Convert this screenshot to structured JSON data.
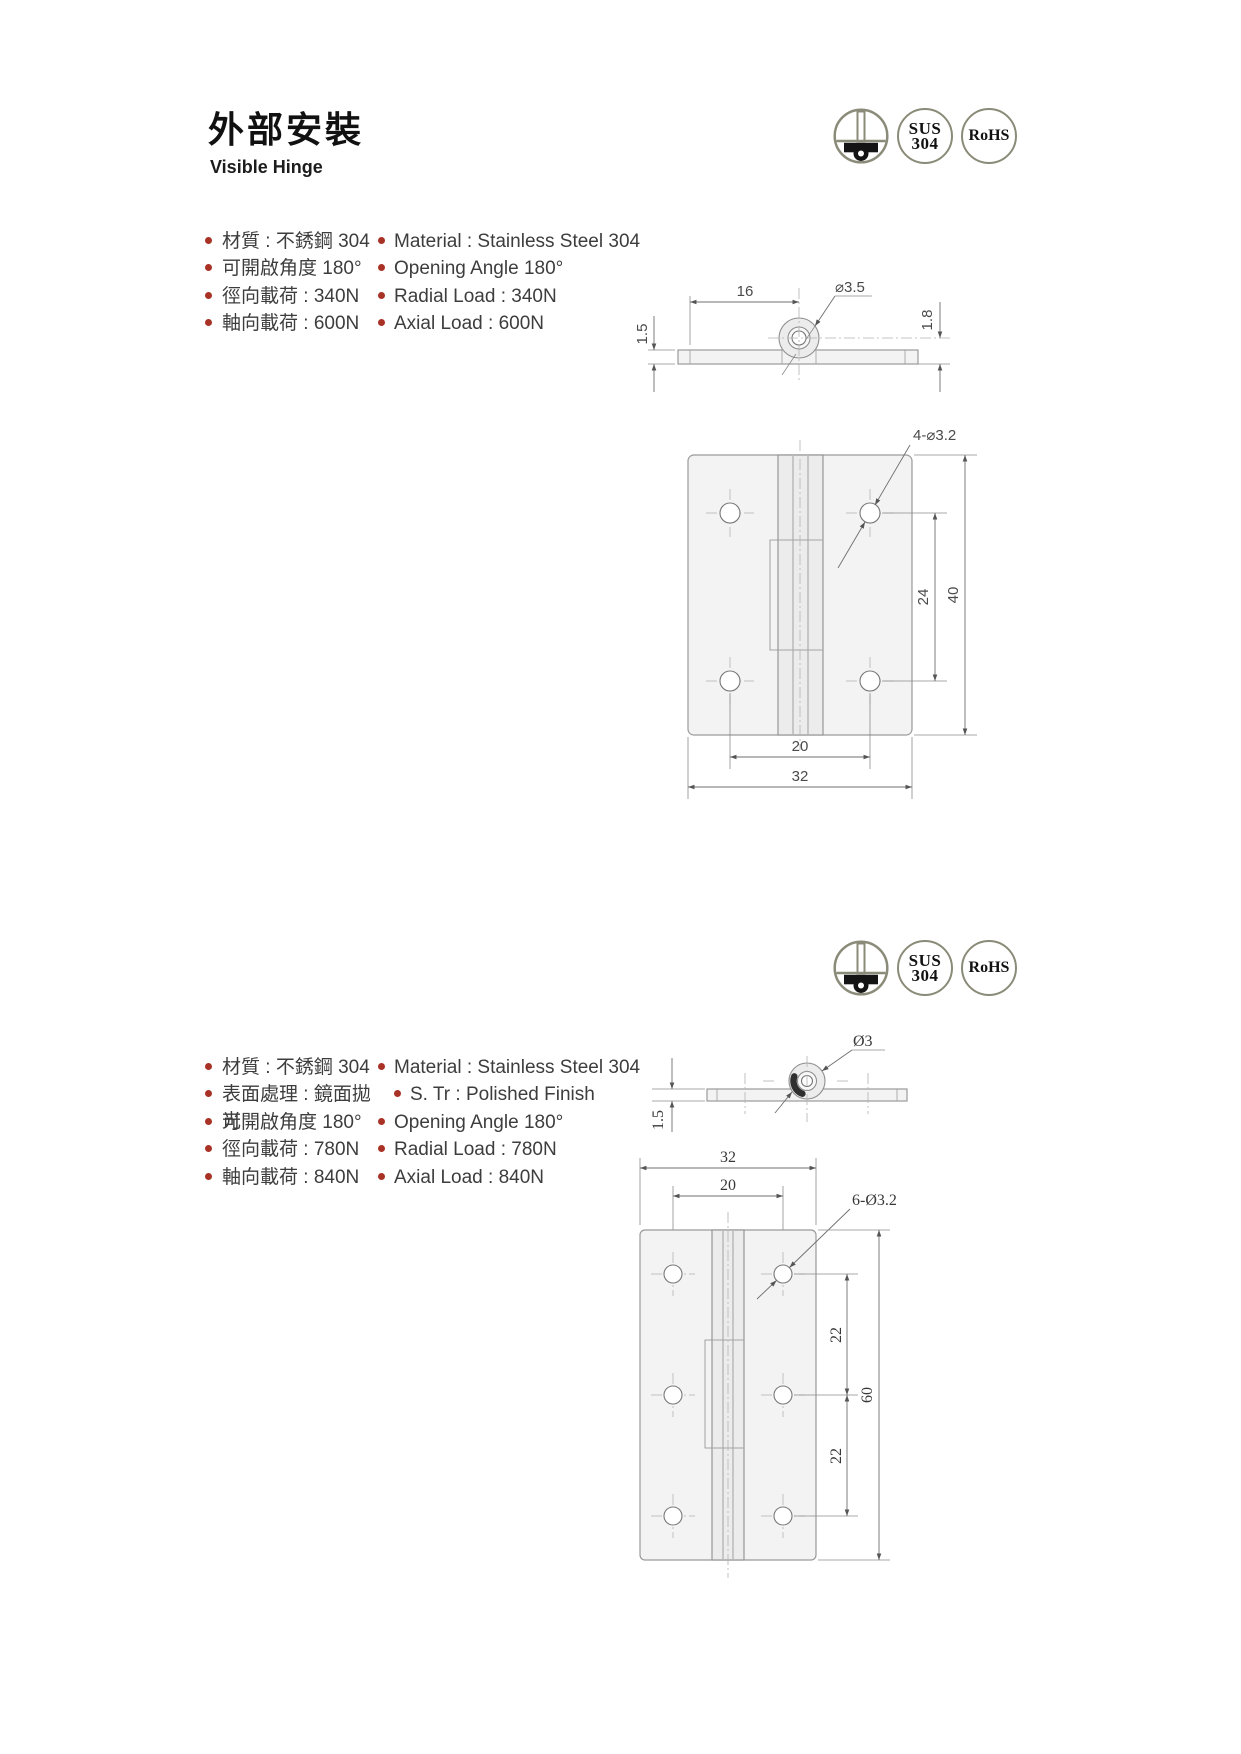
{
  "header": {
    "title_zh": "外部安裝",
    "title_en": "Visible Hinge"
  },
  "badges": {
    "sus_top": "SUS",
    "sus_bottom": "304",
    "rohs": "RoHS"
  },
  "section1": {
    "specs_zh": [
      "材質 : 不銹鋼 304",
      "可開啟角度 180°",
      "徑向載荷 : 340N",
      "軸向載荷 : 600N"
    ],
    "specs_en": [
      "Material : Stainless Steel 304",
      "Opening Angle 180°",
      "Radial Load : 340N",
      "Axial Load : 600N"
    ],
    "profile": {
      "dim_width": "16",
      "dim_pin": "⌀3.5",
      "dim_left_thickness": "1.5",
      "dim_right_thickness": "1.8"
    },
    "front": {
      "dim_holes": "4-⌀3.2",
      "dim_hole_span_v": "24",
      "dim_height": "40",
      "dim_hole_span_h": "20",
      "dim_width": "32"
    }
  },
  "section2": {
    "specs_zh": [
      "材質 : 不銹鋼 304",
      "表面處理 : 鏡面拋光",
      "可開啟角度 180°",
      "徑向載荷 : 780N",
      "軸向載荷 : 840N"
    ],
    "specs_en": [
      "Material : Stainless Steel 304",
      "S. Tr : Polished Finish",
      "Opening Angle 180°",
      "Radial Load : 780N",
      "Axial Load : 840N"
    ],
    "profile": {
      "dim_pin": "Ø3",
      "dim_thickness": "1.5"
    },
    "front": {
      "dim_width": "32",
      "dim_hole_span_h": "20",
      "dim_holes": "6-Ø3.2",
      "dim_span_top": "22",
      "dim_span_bottom": "22",
      "dim_height": "60"
    }
  }
}
